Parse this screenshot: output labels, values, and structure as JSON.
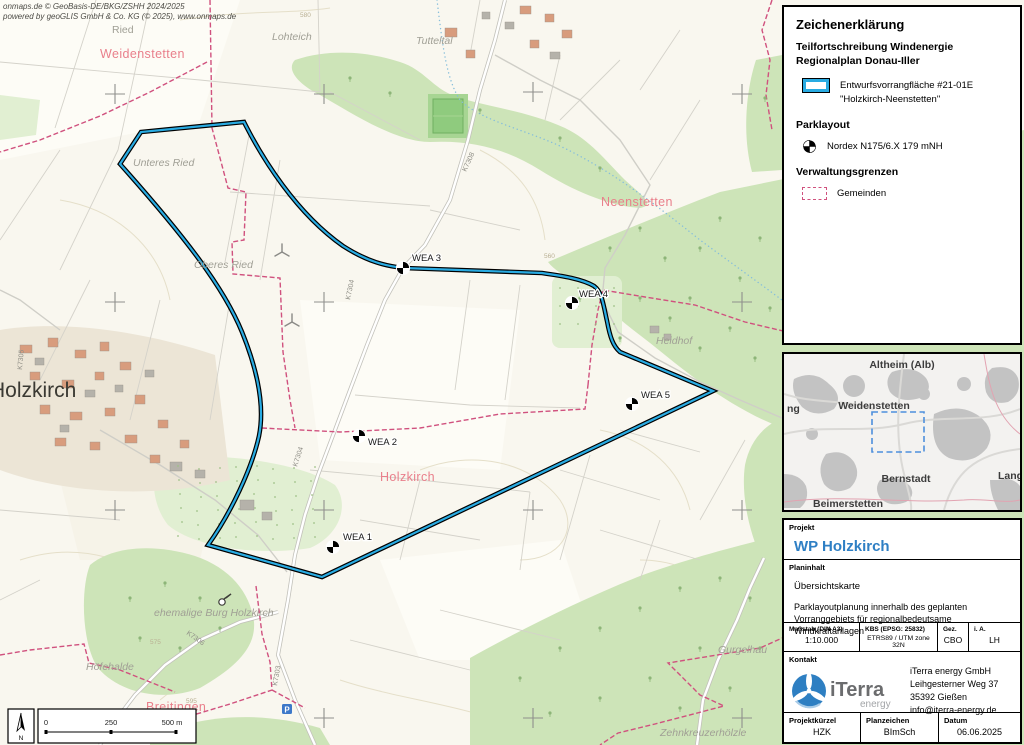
{
  "colors": {
    "accent_cyan": "#29abe2",
    "gemeinde_pink": "#d0517e",
    "project_blue": "#2e7fc4",
    "town_pink": "#e97f8b",
    "forest_green": "#cde4b8"
  },
  "map": {
    "attribution_line1": "onmaps.de © GeoBasis-DE/BKG/ZSHH 2024/2025",
    "attribution_line2": "powered by geoGLIS GmbH & Co. KG (© 2025), www.onmaps.de",
    "labels": [
      {
        "t": "Ried",
        "x": 112,
        "y": 33,
        "c": "lbl-gray"
      },
      {
        "t": "Weidenstetten",
        "x": 100,
        "y": 58,
        "c": "lbl-town"
      },
      {
        "t": "Lohteich",
        "x": 272,
        "y": 40,
        "c": "lbl-gray-i"
      },
      {
        "t": "Tutteltal",
        "x": 416,
        "y": 44,
        "c": "lbl-gray-i"
      },
      {
        "t": "Unteres Ried",
        "x": 133,
        "y": 166,
        "c": "lbl-gray-i"
      },
      {
        "t": "Oberes Ried",
        "x": 194,
        "y": 268,
        "c": "lbl-gray-i"
      },
      {
        "t": "Neenstetten",
        "x": 601,
        "y": 206,
        "c": "lbl-town"
      },
      {
        "t": "Heidhof",
        "x": 656,
        "y": 344,
        "c": "lbl-gray-i"
      },
      {
        "t": "Holzkirch",
        "x": -10,
        "y": 397,
        "c": "lbl-city"
      },
      {
        "t": "Holzkirch",
        "x": 380,
        "y": 481,
        "c": "lbl-town"
      },
      {
        "t": "ehemalige Burg Holzkirch",
        "x": 154,
        "y": 616,
        "c": "lbl-gray-i"
      },
      {
        "t": "Höfehalde",
        "x": 86,
        "y": 670,
        "c": "lbl-gray-i"
      },
      {
        "t": "Breitingen",
        "x": 146,
        "y": 711,
        "c": "lbl-town"
      },
      {
        "t": "Gurgelhau",
        "x": 718,
        "y": 653,
        "c": "lbl-gray-i"
      },
      {
        "t": "Zehnkreuzerhölzle",
        "x": 660,
        "y": 736,
        "c": "lbl-gray-i"
      },
      {
        "t": "K7304",
        "x": 350,
        "y": 300,
        "c": "lbl-road",
        "r": -78
      },
      {
        "t": "K7304",
        "x": 297,
        "y": 467,
        "c": "lbl-road",
        "r": -72
      },
      {
        "t": "K7308",
        "x": 466,
        "y": 172,
        "c": "lbl-road",
        "r": -65
      },
      {
        "t": "K7305",
        "x": 22,
        "y": 370,
        "c": "lbl-road",
        "r": -85
      },
      {
        "t": "K7306",
        "x": 186,
        "y": 634,
        "c": "lbl-road",
        "r": 35
      },
      {
        "t": "K7303",
        "x": 277,
        "y": 686,
        "c": "lbl-road",
        "r": -80
      }
    ],
    "contour_labels": [
      {
        "t": "580",
        "x": 300,
        "y": 17
      },
      {
        "t": "560",
        "x": 544,
        "y": 258
      },
      {
        "t": "575",
        "x": 150,
        "y": 644
      },
      {
        "t": "595",
        "x": 186,
        "y": 703
      }
    ],
    "wea": [
      {
        "n": "WEA 1",
        "x": 333,
        "y": 547,
        "lx": 343,
        "ly": 540
      },
      {
        "n": "WEA 2",
        "x": 359,
        "y": 436,
        "lx": 368,
        "ly": 445
      },
      {
        "n": "WEA 3",
        "x": 403,
        "y": 268,
        "lx": 412,
        "ly": 261
      },
      {
        "n": "WEA 4",
        "x": 572,
        "y": 303,
        "lx": 579,
        "ly": 297
      },
      {
        "n": "WEA 5",
        "x": 632,
        "y": 404,
        "lx": 641,
        "ly": 398
      }
    ],
    "scalebar": {
      "v0": "0",
      "v1": "250",
      "v2": "500 m",
      "north": "N"
    },
    "parking_icon": "P"
  },
  "legend": {
    "title": "Zeichenerklärung",
    "subtitle": "Teilfortschreibung Windenergie Regionalplan Donau-Iller",
    "area_item_line1": "Entwurfsvorrangfläche #21-01E",
    "area_item_line2": "\"Holzkirch-Neenstetten\"",
    "sec_park": "Parklayout",
    "turbine_item": "Nordex N175/6.X 179 mNH",
    "sec_admin": "Verwaltungsgrenzen",
    "gemeinden_item": "Gemeinden"
  },
  "overview": {
    "labels": [
      {
        "t": "Altheim (Alb)",
        "x": 118,
        "y": 14,
        "a": "middle"
      },
      {
        "t": "Weidenstetten",
        "x": 90,
        "y": 55,
        "a": "middle"
      },
      {
        "t": "Bernstadt",
        "x": 122,
        "y": 128,
        "a": "middle"
      },
      {
        "t": "Langenau",
        "x": 214,
        "y": 125,
        "a": "start"
      },
      {
        "t": "Beimerstetten",
        "x": 64,
        "y": 153,
        "a": "middle"
      },
      {
        "t": "ng",
        "x": 3,
        "y": 58,
        "a": "start"
      }
    ]
  },
  "project": {
    "label": "Projekt",
    "name": "WP Holzkirch"
  },
  "plan": {
    "label": "Planinhalt",
    "subtitle": "Übersichtskarte",
    "text": "Parklayoutplanung innerhalb des geplanten Vorranggebiets für regionalbedeutsame Windkraftanlagen"
  },
  "meta": {
    "cols": [
      {
        "h": "Maßstab (DIN A3)",
        "v": "1:10.000"
      },
      {
        "h": "KBS (EPSG: 25832)",
        "v": "ETRS89 / UTM zone 32N"
      },
      {
        "h": "Gez.",
        "v": "CBO"
      },
      {
        "h": "i. A.",
        "v": "LH"
      }
    ]
  },
  "kontakt": {
    "label": "Kontakt",
    "logo_text": "iTerra",
    "logo_sub": "energy",
    "lines": [
      "iTerra energy GmbH",
      "Leihgesterner Weg 37",
      "35392 Gießen",
      "info@iterra-energy.de"
    ]
  },
  "footer": {
    "cols": [
      {
        "h": "Projektkürzel",
        "v": "HZK"
      },
      {
        "h": "Planzeichen",
        "v": "BImSch"
      },
      {
        "h": "Datum",
        "v": "06.06.2025"
      }
    ]
  }
}
